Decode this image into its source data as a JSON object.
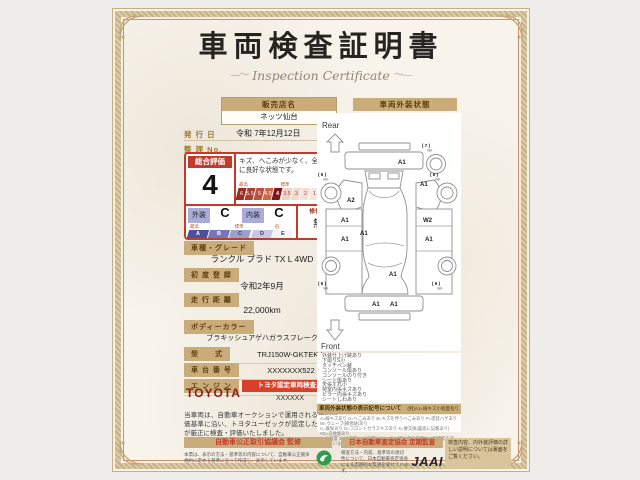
{
  "colors": {
    "accent_red": "#c43a2a",
    "deep_red": "#8b1a1a",
    "badge_red": "#d8402a",
    "tan_bar": "#c9ac79",
    "lavender": "#a9acd6",
    "green_mark": "#2f9e4c",
    "jaai": "#22232d",
    "note_bg": "#d8c59c"
  },
  "certificate": {
    "title": "車両検査証明書",
    "subtitle": "Inspection Certificate"
  },
  "dealer": {
    "label": "販売店名",
    "name": "ネッツ仙台",
    "issue_date_label": "発 行 日",
    "issue_date": "令和 7年12月12日",
    "ref_no_label": "整 理 No.",
    "ref_no": ""
  },
  "rating": {
    "overall_label": "総合評価",
    "overall_value": "4",
    "comment": "キズ、へこみが少なく、全体的に良好な状態です。",
    "scale_labels": {
      "best": "最高",
      "standard": "標準",
      "low": "低"
    },
    "numeric_scale": [
      "6",
      "5.5",
      "5",
      "4.5",
      "4",
      "3.5",
      "3",
      "2",
      "1",
      "RA",
      "R"
    ],
    "numeric_selected": "4",
    "exterior_label": "外装",
    "exterior_value": "C",
    "interior_label": "内装",
    "interior_value": "C",
    "letter_scale": [
      "A",
      "B",
      "C",
      "D",
      "E"
    ],
    "repair_label": "修復歴",
    "repair_value": "無"
  },
  "details": [
    {
      "label": "車種・グレード",
      "value": "ランクル プラド TX L 4WD"
    },
    {
      "label": "初 度 登 録",
      "value": "令和2年9月"
    },
    {
      "label": "走 行 距 離",
      "value": "22,000km"
    },
    {
      "label": "ボディーカラー",
      "value": "ブラキッシュアゲハガラスフレーク"
    }
  ],
  "specs": [
    {
      "label": "型　　式",
      "value": "TRJ150W-GKTEK-L"
    },
    {
      "label": "車 台 番 号",
      "value": "XXXXXXX522"
    },
    {
      "label": "エ ン ジ ン",
      "value": "ガソリン"
    }
  ],
  "inspector": {
    "brand": "TOYOTA",
    "badge": "トヨタ認定車両検査員",
    "inspector_id": "XXXXXX"
  },
  "disclaimer": "当車両は、自動車オークションで運用される車両評価基準に沿い、トヨタユーゼックが認定した検査員が厳正に検査・評価いたしました。",
  "exterior_diagram": {
    "header": "車両外装状態",
    "rear_label": "Rear",
    "front_label": "Front",
    "tire_unit": "mm",
    "markers": [
      {
        "code": "( 7 )",
        "x": 104,
        "y": 33,
        "tire": true
      },
      {
        "code": "A1",
        "x": 80,
        "y": 50
      },
      {
        "code": "( 6 )",
        "x": 0,
        "y": 62,
        "tire": true
      },
      {
        "code": "( 6 )",
        "x": 112,
        "y": 62,
        "tire": true
      },
      {
        "code": "A2",
        "x": 29,
        "y": 88
      },
      {
        "code": "A1",
        "x": 102,
        "y": 72
      },
      {
        "code": "A1",
        "x": 23,
        "y": 108
      },
      {
        "code": "W2",
        "x": 105,
        "y": 108
      },
      {
        "code": "A1",
        "x": 42,
        "y": 121
      },
      {
        "code": "A1",
        "x": 23,
        "y": 127
      },
      {
        "code": "A1",
        "x": 107,
        "y": 127
      },
      {
        "code": "A1",
        "x": 71,
        "y": 162
      },
      {
        "code": "A1",
        "x": 54,
        "y": 192
      },
      {
        "code": "A1",
        "x": 72,
        "y": 192
      },
      {
        "code": "( 6 )",
        "x": 0,
        "y": 171,
        "tire": true
      },
      {
        "code": "( 6 )",
        "x": 114,
        "y": 171,
        "tire": true
      }
    ],
    "notes": [
      "外装仕上げ跡あり",
      "下廻りS小",
      "タッチペン跡",
      "コンソール傷あり",
      "コンソールのり付き",
      "シート傷あり",
      "天張すれ小",
      "荷室内張キズあり",
      "ピラー内張キズあり",
      "シートしわあり"
    ],
    "symbol_header": "車両外装状態の表示記号について",
    "symbol_example": "(例)A1=線キズ小程度有り",
    "symbol_lines": [
      "A=線キズあり U=へこみあり B=キズを伴うへこみあり P=塗装ハゲあり W=ウェーブ(補修跡)あり",
      "C=腐食あり O=フロントガラスキズあり X=要交換(裏面に記載あり) XX=交換歴あり",
      "1=小程度 2=中程度 3=中程度以上 ・サイズや傷の数等は、程度差を表示しています。"
    ]
  },
  "footer": {
    "left_bar": "自動車公正取引協議会 監修",
    "left_text": "本票は、表示の方法・基準等の内容について、自動車公正競争規約に定める基準に沿って作成し、表示しています。",
    "right_bar": "日本自動車査定協会 定期監査",
    "right_text": "検査方法・内容、基準等の適切性について、日本自動車査定協会による定期的な監査を受けています。",
    "jaai": "JAAI",
    "note": "検査内容、内外装評価の詳しい説明については裏面をご覧ください。"
  }
}
